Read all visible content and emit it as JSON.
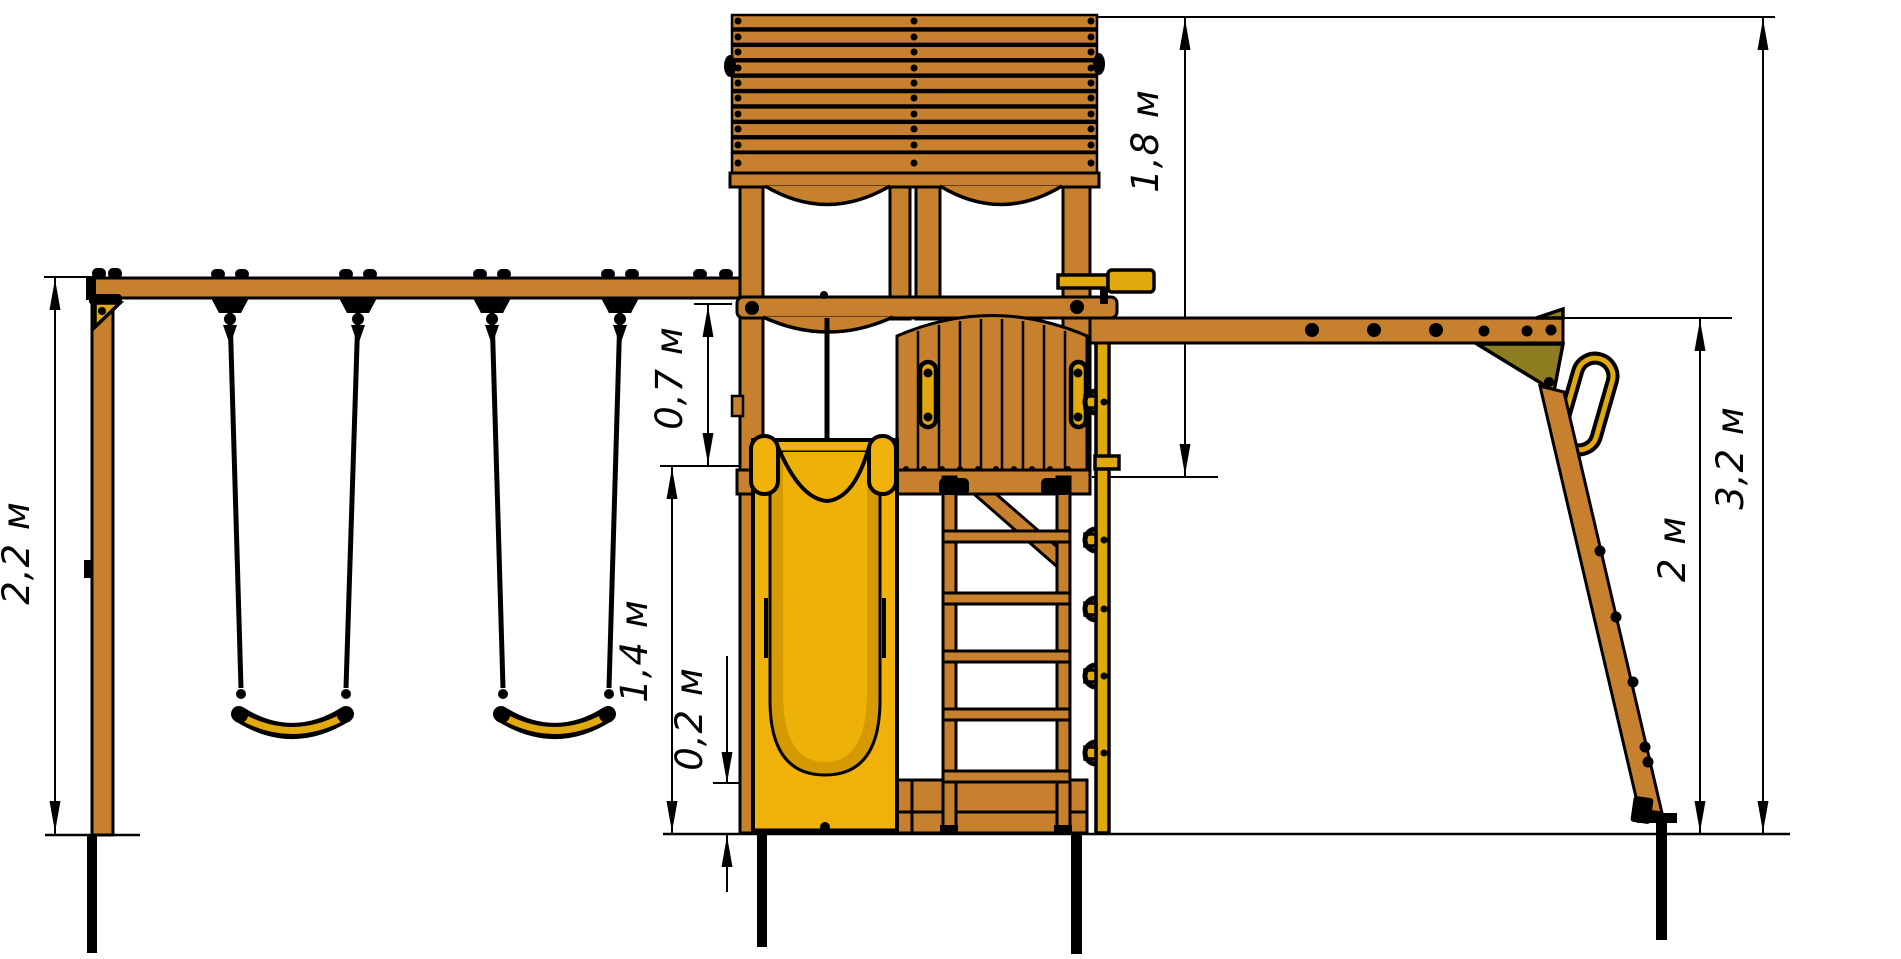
{
  "diagram": {
    "kind": "playground-equipment-side-elevation",
    "units": "м"
  },
  "dimensions": {
    "swing_beam_height": "2,2 м",
    "beam_to_deck_offset": "0,7 м",
    "slide_section_height": "1,4 м",
    "slide_exit_height": "0,2 м",
    "roof_to_deck": "1,8 м",
    "monkey_bar_height": "2 м",
    "total_height": "3,2 м"
  },
  "colors": {
    "wood": "#C6802E",
    "slide_yellow": "#F0B10A",
    "accent_yellow": "#E2A90C",
    "olive": "#8E7D20",
    "outline": "#000000",
    "background": "#FFFFFF"
  }
}
